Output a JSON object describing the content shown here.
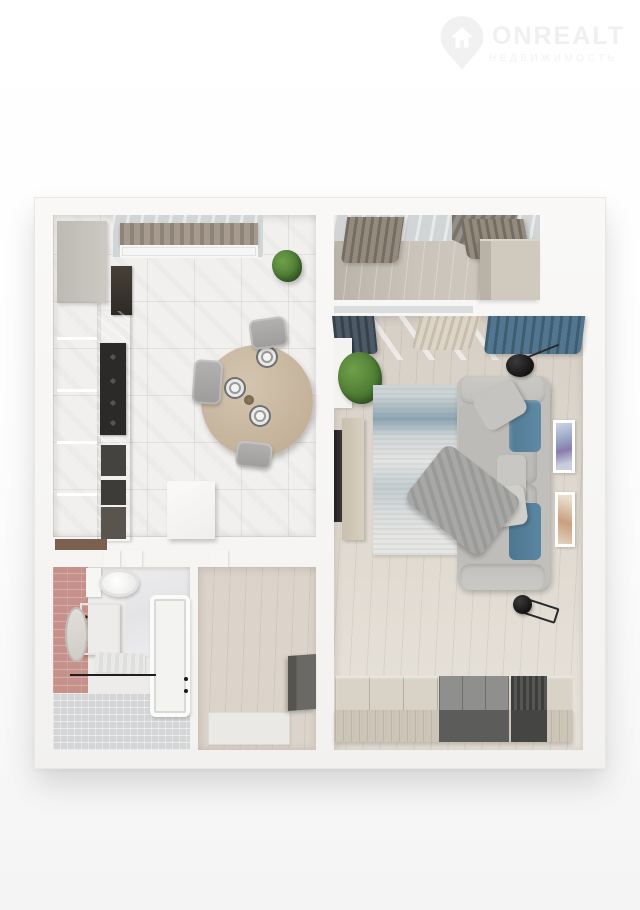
{
  "watermark": {
    "brand": "ONREALT",
    "subtitle": "НЕДВИЖИМОСТЬ",
    "icon": "house-pin-icon",
    "color": "#f0f0f0"
  },
  "palette": {
    "background": "#fdfdfd",
    "wall_white": "#f6f5f3",
    "kitchen_floor": "#f1f0ee",
    "wood_floor": "#dcd4ca",
    "living_floor": "#e0dad1",
    "balcony_floor": "#c8c1b7",
    "bathroom_tile": "#d4d5d7",
    "pink_wall": "#c6918a",
    "sofa_gray": "#c1bfbb",
    "accent_blue": "#5b87a3",
    "curtain_brown": "#8c8378",
    "curtain_navy": "#42505c",
    "curtain_blue": "#48687c",
    "plant_green": "#4c7a33",
    "table_wood": "#c8b9a3",
    "dark_furniture": "#4f4f4d",
    "rug_blue": "#5c8299"
  },
  "floorplan": {
    "type": "apartment-top-down-3d-render",
    "rooms": [
      {
        "name": "kitchen"
      },
      {
        "name": "balcony"
      },
      {
        "name": "living-room"
      },
      {
        "name": "bathroom"
      },
      {
        "name": "hallway"
      }
    ]
  }
}
